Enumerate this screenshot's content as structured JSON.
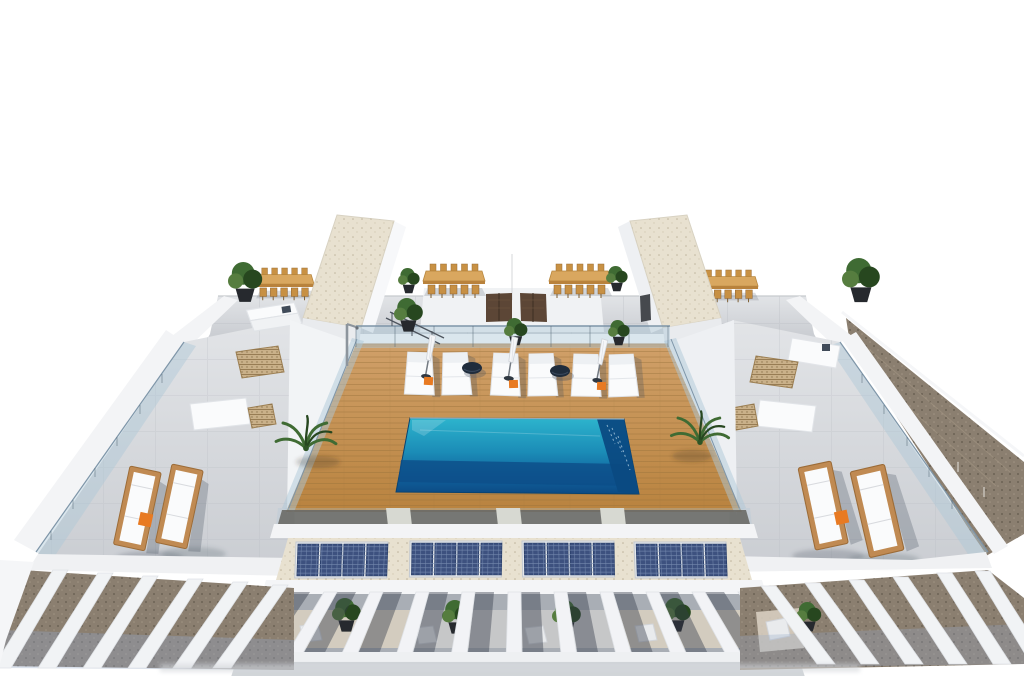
{
  "scene": {
    "type": "architectural_3d_render",
    "subject": "aerial-rooftop-terrace-with-swimming-pool",
    "background": "white-sky"
  },
  "inventory": {
    "swimming_pool": 1,
    "stair_towers": 2,
    "dining_sets": 4,
    "pool_loungers": 6,
    "closed_parasols": 3,
    "round_side_tables": 2,
    "wood_loungers_side_roofs": 4,
    "solar_panel_groups": 4,
    "solar_panels_per_group": 4,
    "pergola_columns_front": 11,
    "entry_doors": 2,
    "palm_planters": 2,
    "skylight_grates": 4
  },
  "colors": {
    "bg": "#ffffff",
    "concrete_light": "#e2e4e7",
    "concrete_mid": "#cbced3",
    "wall_white": "#f3f4f6",
    "wall_shadow": "#dcdee2",
    "gravel_beige": "#e8e1d0",
    "gravel_brown": "#8b7f70",
    "deck_light": "#d0a069",
    "deck_dark": "#b9833f",
    "deck_line": "#96703a",
    "wood_table": "#d9a75f",
    "wood_table_dark": "#b9823c",
    "pool_top": "#2db4cd",
    "pool_mid": "#1b8cb7",
    "pool_deep": "#10619c",
    "pool_deepest": "#0c4a84",
    "glass": "#aec8d8",
    "glass_edge": "#7e95a8",
    "solar_cell": "#3d517f",
    "solar_grid": "#7b90b4",
    "orange": "#e87a22",
    "plant_green": "#3f6b33",
    "plant_dark": "#27471f",
    "furniture_white": "#fafbfc",
    "dark_navy": "#1f2c3c",
    "door_brown": "#5c4636",
    "pergola_shade": "#a9aeb5"
  }
}
